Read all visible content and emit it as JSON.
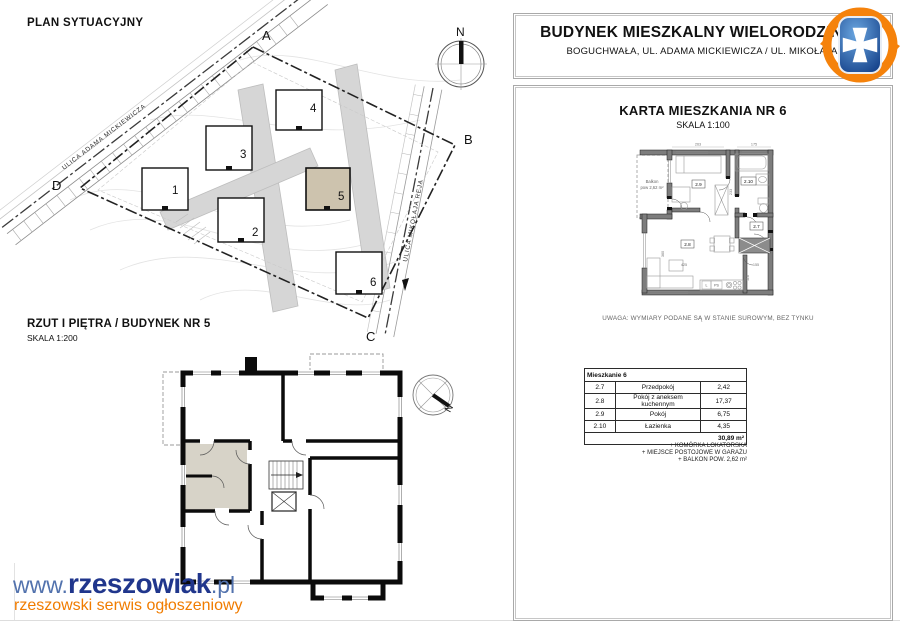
{
  "site_plan": {
    "title": "PLAN SYTUACYJNY",
    "street_top": "ULICA ADAMA MICKIEWICZA",
    "street_right": "ULICA MIKOŁAJA REJA",
    "corner_a": "A",
    "corner_b": "B",
    "corner_c": "C",
    "corner_d": "D",
    "buildings": [
      "1",
      "2",
      "3",
      "4",
      "5",
      "6"
    ],
    "north": "N"
  },
  "floor_plan": {
    "title": "RZUT I PIĘTRA / BUDYNEK NR 5",
    "scale": "SKALA 1:200",
    "north": "N"
  },
  "header": {
    "title": "BUDYNEK MIESZKALNY WIELORODZINNY",
    "subtitle": "BOGUCHWAŁA, UL. ADAMA MICKIEWICZA / UL. MIKOŁAJA"
  },
  "card": {
    "title": "KARTA MIESZKANIA NR 6",
    "scale": "SKALA 1:100",
    "note": "UWAGA: WYMIARY PODANE SĄ W STANIE SUROWYM, BEZ TYNKU",
    "balcony_line1": "Balkon",
    "balcony_line2": "pow 2,62 m²",
    "room_27": "2.7",
    "room_28": "2.8",
    "room_29": "2.9",
    "room_210": "2.10",
    "dim_263": "263",
    "dim_175": "175",
    "dim_233": "233",
    "dim_360": "360",
    "dim_425": "425",
    "dim_155": "155",
    "dim_116": "116",
    "kitchen_l": "L",
    "kitchen_ps": "PS"
  },
  "table": {
    "header": "Mieszkanie 6",
    "rows": [
      {
        "no": "2.7",
        "name": "Przedpokój",
        "area": "2,42"
      },
      {
        "no": "2.8",
        "name": "Pokój z aneksem kuchennym",
        "area": "17,37"
      },
      {
        "no": "2.9",
        "name": "Pokój",
        "area": "6,75"
      },
      {
        "no": "2.10",
        "name": "Łazienka",
        "area": "4,35"
      }
    ],
    "total": "30,89 m²",
    "extras": [
      "+ KOMÓRKA LOKATORSKA",
      "+ MIEJSCE POSTOJOWE W GARAŻU",
      "+ BALKON POW. 2,62 m²"
    ]
  },
  "footer": {
    "www": "www.",
    "brand": "rzeszowiak",
    "tld": ".pl",
    "tagline": "rzeszowski serwis ogłoszeniowy"
  },
  "colors": {
    "highlight_building": "#cdc3ae",
    "highlight_apartment": "#d7d3c8",
    "brand_blue": "#20368c",
    "brand_light_blue": "#5272ad",
    "brand_orange": "#f07c00",
    "crest_blue": "#1c4793",
    "crest_orange": "#f5820b"
  }
}
